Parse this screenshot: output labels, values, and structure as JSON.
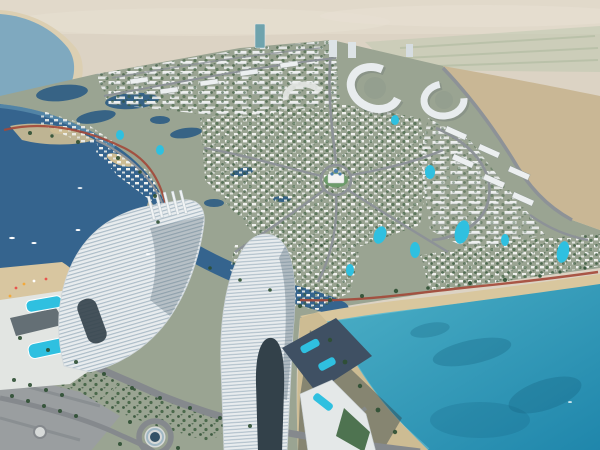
{
  "scene": {
    "type": "aerial-architectural-rendering",
    "description": "Aerial rendering of a coastal master-planned resort community: curved white high-rise towers in the foreground, a deep blue bay on the left, a turquoise lagoon with sandy beach at lower right, dense villa and apartment districts with winding roads and a red jogging track, desert stretching beyond",
    "colors": {
      "desert_far": "#dcd3c4",
      "desert_haze": "#e7e0d2",
      "desert_near": "#c9b795",
      "fields": "#bfc9b0",
      "field_lines": "#a9b79b",
      "sea": "#7fa9bf",
      "sea_beach": "#dccfb2",
      "bay": "#35648e",
      "bay_shallow": "#6fa3bd",
      "inner_lake": "#2f5e84",
      "lagoon_deep": "#1f86ab",
      "lagoon_shallow": "#4fb2c8",
      "lagoon_glow": "#8fd4de",
      "seagrass": "#14607f",
      "beach_sand": "#d9c79e",
      "spit_sand": "#cdbc93",
      "development_ground": "#9aa492",
      "trees": "#2e4f33",
      "roads": "#8d9297",
      "foreground_road": "#85898d",
      "jogging_track": "#a34838",
      "tower_facade": "#e8ecee",
      "tower_bands": "#a9bac6",
      "tower_shade": "#5d707c",
      "arch_opening": "#33414a",
      "pool_water": "#2fc0e0",
      "rooftop_deck": "#3f5063",
      "terrace_white": "#e4e8e8",
      "landmark_green": "#6d9b6a",
      "landmark_dome": "#4a7fae",
      "shadow": "#31424a",
      "boat": "#ffffff",
      "glass_tower": "#6fa3ad",
      "plaza": "#d7dad9",
      "row_building": "#eceff0"
    },
    "features": {
      "left_tower": "curved high-rise with rooftop fins and beach podium pools",
      "center_tower": "tall curved tower with arch opening and rooftop pool deck",
      "bay": "deep blue inlet with boats and sandy spits",
      "lagoon": "turquoise swimming lagoon with beach",
      "landmark": "domed clubhouse on central roundabout",
      "districts": "villa neighborhoods, crescent apartment blocks, row houses",
      "desert": "open desert with distant green fields"
    }
  }
}
